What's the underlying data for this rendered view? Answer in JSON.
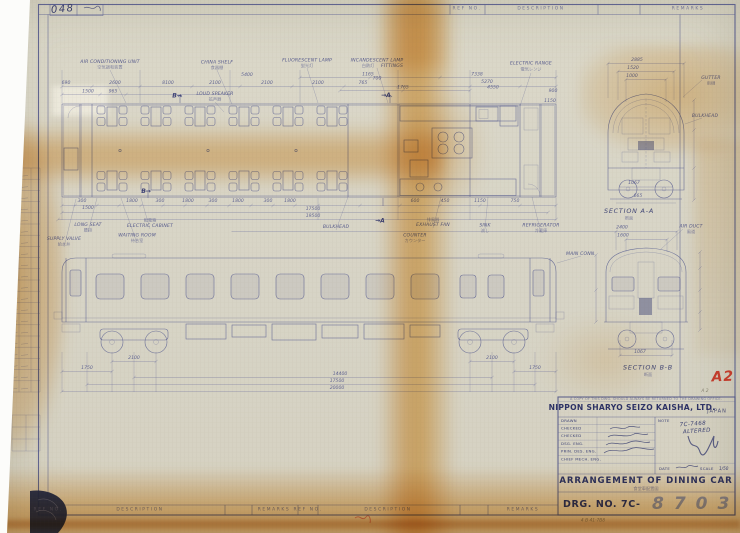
{
  "sheet": {
    "sheet_number": "048",
    "red_grade_mark": "A2",
    "pencil_grade_mark": "A 2",
    "pencil_note": "4 B 41·7B8",
    "paper_color": "#d8d5c6",
    "ink_color": "#565b90",
    "stain_color": "#e09326",
    "red_mark_color": "#c23b2b"
  },
  "column_headers": [
    [
      "REF NO.",
      467,
      9.7
    ],
    [
      "DESCRIPTION",
      541,
      9.7
    ],
    [
      "REMARKS",
      688,
      9.7
    ],
    [
      "REF NO.",
      48,
      510.7
    ],
    [
      "DESCRIPTION",
      140,
      510.7
    ],
    [
      "REMARKS",
      274,
      510.7
    ],
    [
      "REF NO.",
      308,
      510.7
    ],
    [
      "DESCRIPTION",
      388,
      510.7
    ],
    [
      "REMARKS",
      523,
      510.7
    ]
  ],
  "plan": {
    "part_labels": [
      [
        "AIR CONDITIONING UNIT",
        110,
        63
      ],
      [
        "CHINA SHELF",
        217,
        63.5
      ],
      [
        "FLUORESCENT LAMP",
        307,
        61.5
      ],
      [
        "INCANDESCENT LAMP",
        377,
        61.5
      ],
      [
        "FITTINGS",
        392,
        67
      ],
      [
        "ELECTRIC RANGE",
        531,
        64.5
      ],
      [
        "LOUD SPEAKER",
        215,
        95
      ],
      [
        "LONG SEAT",
        88,
        226
      ],
      [
        "ELECTRIC CABINET",
        150,
        227
      ],
      [
        "WAITING ROOM",
        137,
        236.5
      ],
      [
        "SUPPLY VALVE",
        64,
        240
      ],
      [
        "BULKHEAD",
        336,
        228
      ],
      [
        "EXHAUST FAN",
        433,
        226
      ],
      [
        "COUNTER",
        415,
        236.5
      ],
      [
        "SINK",
        485,
        226.5
      ],
      [
        "REFRIGERATOR",
        541,
        226.5
      ],
      [
        "MAIN CONN.",
        581,
        255
      ],
      [
        "GUTTER",
        711,
        79
      ],
      [
        "BULKHEAD",
        705,
        117
      ],
      [
        "AIR DUCT",
        691,
        227.5
      ]
    ],
    "part_labels_jp": [
      [
        "空気調和装置",
        110,
        68.5
      ],
      [
        "食器棚",
        217,
        69
      ],
      [
        "蛍光灯",
        307,
        67
      ],
      [
        "白熱灯",
        368,
        67
      ],
      [
        "電気レンジ",
        531,
        70.5
      ],
      [
        "拡声器",
        215,
        100.5
      ],
      [
        "腰掛",
        88,
        231.5
      ],
      [
        "配電箱",
        150,
        221.5
      ],
      [
        "待合室",
        137,
        242
      ],
      [
        "給水弁",
        64,
        245.5
      ],
      [
        "排風器",
        433,
        220.8
      ],
      [
        "カウンター",
        415,
        241.8
      ],
      [
        "流し",
        485,
        231.8
      ],
      [
        "冷蔵庫",
        541,
        232
      ],
      [
        "雨樋",
        711,
        84.5
      ],
      [
        "風道",
        691,
        232.8
      ]
    ]
  },
  "dimensions": {
    "plan_top": [
      [
        "690",
        66,
        84
      ],
      [
        "2600",
        115,
        84
      ],
      [
        "8100",
        168,
        84
      ],
      [
        "2100",
        215,
        84
      ],
      [
        "5400",
        247,
        76
      ],
      [
        "2100",
        267,
        84
      ],
      [
        "1500",
        88,
        92.5
      ],
      [
        "965",
        113,
        92.5
      ],
      [
        "2100",
        318,
        84
      ],
      [
        "1165",
        368,
        75.5
      ],
      [
        "765",
        363,
        84
      ],
      [
        "700",
        377,
        79.5
      ],
      [
        "1765",
        403,
        88.5
      ],
      [
        "7338",
        477,
        75.5
      ],
      [
        "5270",
        487,
        83
      ],
      [
        "4550",
        493,
        88.5
      ],
      [
        "900",
        553,
        92
      ],
      [
        "1150",
        550,
        102
      ]
    ],
    "plan_bottom": [
      [
        "300",
        82,
        202
      ],
      [
        "1800",
        132,
        202
      ],
      [
        "300",
        160,
        202
      ],
      [
        "1800",
        188,
        202
      ],
      [
        "300",
        213,
        202
      ],
      [
        "1800",
        238,
        202
      ],
      [
        "300",
        268,
        202
      ],
      [
        "1800",
        290,
        202
      ],
      [
        "1500",
        88,
        209
      ],
      [
        "600",
        415,
        202
      ],
      [
        "450",
        445,
        202
      ],
      [
        "1150",
        480,
        202
      ],
      [
        "750",
        515,
        202
      ],
      [
        "17500",
        313,
        210
      ],
      [
        "19500",
        313,
        217
      ]
    ],
    "elevation": [
      [
        "2100",
        134,
        359
      ],
      [
        "2100",
        492,
        359
      ],
      [
        "1750",
        87,
        369
      ],
      [
        "1750",
        535,
        369
      ],
      [
        "14400",
        340,
        375
      ],
      [
        "17500",
        337,
        382
      ],
      [
        "20000",
        337,
        389
      ]
    ],
    "sections": [
      [
        "2885",
        637,
        61
      ],
      [
        "1520",
        633,
        69
      ],
      [
        "1000",
        632,
        77
      ],
      [
        "1067",
        634,
        184
      ],
      [
        "665",
        638,
        197
      ],
      [
        "2400",
        622,
        228.5
      ],
      [
        "1600",
        623,
        236.5
      ],
      [
        "1067",
        640,
        353
      ]
    ]
  },
  "sections": {
    "labels": [
      [
        "SECTION A-A",
        629,
        213
      ],
      [
        "SECTION B-B",
        648,
        369.5
      ]
    ],
    "labels_jp": [
      [
        "断面",
        629,
        219.5
      ],
      [
        "断面",
        648,
        376
      ]
    ]
  },
  "cut_arrows": [
    [
      "→A",
      386,
      97
    ],
    [
      "→A",
      380,
      222.5
    ],
    [
      "B→",
      177,
      97.5
    ],
    [
      "B→",
      146,
      193
    ]
  ],
  "title_block": {
    "copy_note": "A COPY OF THIS DWG. SHOULD ALWAYS BE RETURNED TO THE DRAWING OFFICE.",
    "company": "NIPPON SHARYO SEIZO KAISHA, LTD.",
    "country": "JAPAN",
    "approval_rows": [
      "DRAWN",
      "CHECKED",
      "CHECKED",
      "DSG. ENG.",
      "PRIN. DES. ENG.",
      "CHIEF MECH. ENG."
    ],
    "note_label": "NOTE",
    "note_value": "7C-7468",
    "note_value2": "ALTERED",
    "date_label": "DATE",
    "scale_label": "SCALE",
    "scale_value": "1/50",
    "title": "ARRANGEMENT OF DINING CAR",
    "title_jp": "食堂車配置図",
    "drg_label": "DRG. NO. 7C-",
    "drg_number": "8703"
  }
}
